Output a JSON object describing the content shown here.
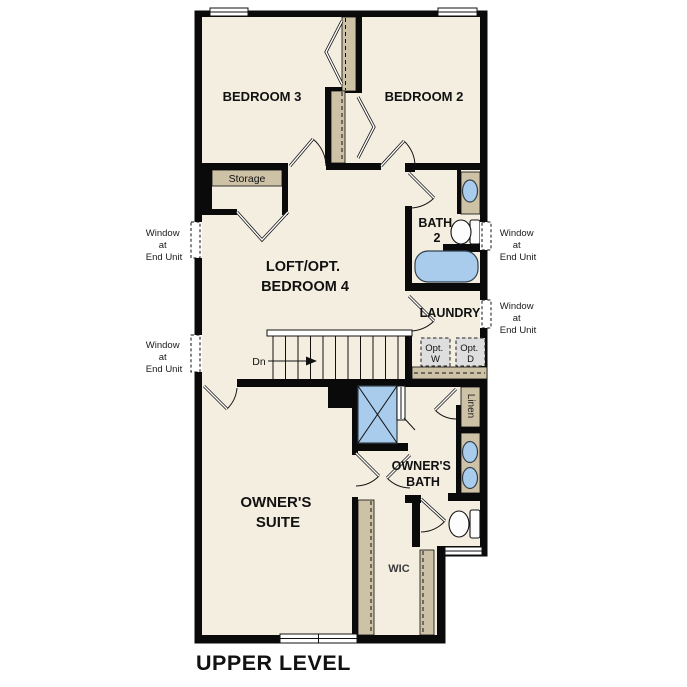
{
  "page": {
    "title": "UPPER LEVEL"
  },
  "colors": {
    "floor": "#f4eee0",
    "wall": "#0a0a0a",
    "closet_shelf": "#cec2a6",
    "fixture_blue": "#a9cbec",
    "appliance_gray": "#dedede"
  },
  "rooms": {
    "bedroom3": "BEDROOM 3",
    "bedroom2": "BEDROOM 2",
    "loft_line1": "LOFT/OPT.",
    "loft_line2": "BEDROOM 4",
    "bath2_line1": "BATH",
    "bath2_line2": "2",
    "laundry": "LAUNDRY",
    "owners_suite_line1": "OWNER'S",
    "owners_suite_line2": "SUITE",
    "owners_bath_line1": "OWNER'S",
    "owners_bath_line2": "BATH",
    "wic": "WIC",
    "storage": "Storage",
    "linen": "Linen"
  },
  "annotations": {
    "window_note": {
      "line1": "Window",
      "line2": "at",
      "line3": "End Unit"
    },
    "stairs_down": "Dn",
    "opt_washer": {
      "line1": "Opt.",
      "line2": "W"
    },
    "opt_dryer": {
      "line1": "Opt.",
      "line2": "D"
    }
  }
}
